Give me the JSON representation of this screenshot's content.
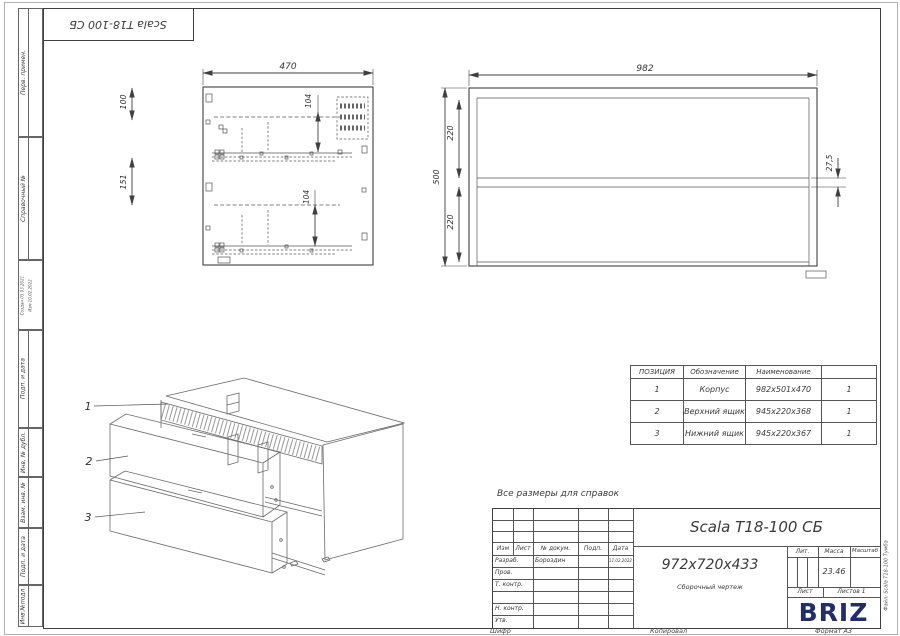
{
  "page": {
    "top_designation": "Scala T18-100 СБ",
    "note": "Все размеры для справок",
    "cipher_label": "Шифр",
    "copied_label": "Копировал",
    "format_label": "Формат А3",
    "file_label": "Файл: Scala Т18-100 Тумба"
  },
  "margin": {
    "labels": [
      "Перв. примен.",
      "Справочный №",
      "Подп. и дата",
      "Инв. № дубл.",
      "Взам. инв. №",
      "Подп. и дата",
      "Инв.№подл."
    ],
    "created": "Создан 05.03.2021",
    "modified": "Изм 10.02.2022"
  },
  "side_view": {
    "w": "470",
    "d104a": "104",
    "d104b": "104",
    "d100": "100",
    "d151": "151"
  },
  "front_view": {
    "w": "982",
    "h": "500",
    "d220a": "220",
    "d220b": "220",
    "gap": "27,5"
  },
  "iso_view": {
    "p1": "1",
    "p2": "2",
    "p3": "3"
  },
  "parts_table": {
    "h_pos": "ПОЗИЦИЯ",
    "h_designation": "Обозначение",
    "h_name": "Наименование",
    "h_qty": "",
    "rows": [
      {
        "pos": "1",
        "name": "Корпус",
        "size": "982х501х470",
        "qty": "1"
      },
      {
        "pos": "2",
        "name": "Верхний ящик",
        "size": "945х220х368",
        "qty": "1"
      },
      {
        "pos": "3",
        "name": "Нижний ящик",
        "size": "945х220х367",
        "qty": "1"
      }
    ]
  },
  "title_block": {
    "title": "Scala T18-100 СБ",
    "dimensions": "972х720х433",
    "doc_type": "Сборочный чертеж",
    "col_izm": "Изм",
    "col_list": "Лист",
    "col_doc": "№ докум.",
    "col_sign": "Подп.",
    "col_date": "Дата",
    "row_dev": "Разраб.",
    "dev_name": "Бороздин",
    "dev_date": "11.02.2022",
    "row_check": "Пров.",
    "row_tcontrol": "Т. контр.",
    "row_ncontrol": "Н. контр.",
    "row_approve": "Утв.",
    "lit": "Лит.",
    "mass": "Масса",
    "scale": "Масштаб",
    "mass_value": "23.46",
    "sheet": "Лист",
    "sheets": "Листов 1",
    "brand": "BRIZ",
    "brand_color": "#232d66"
  }
}
